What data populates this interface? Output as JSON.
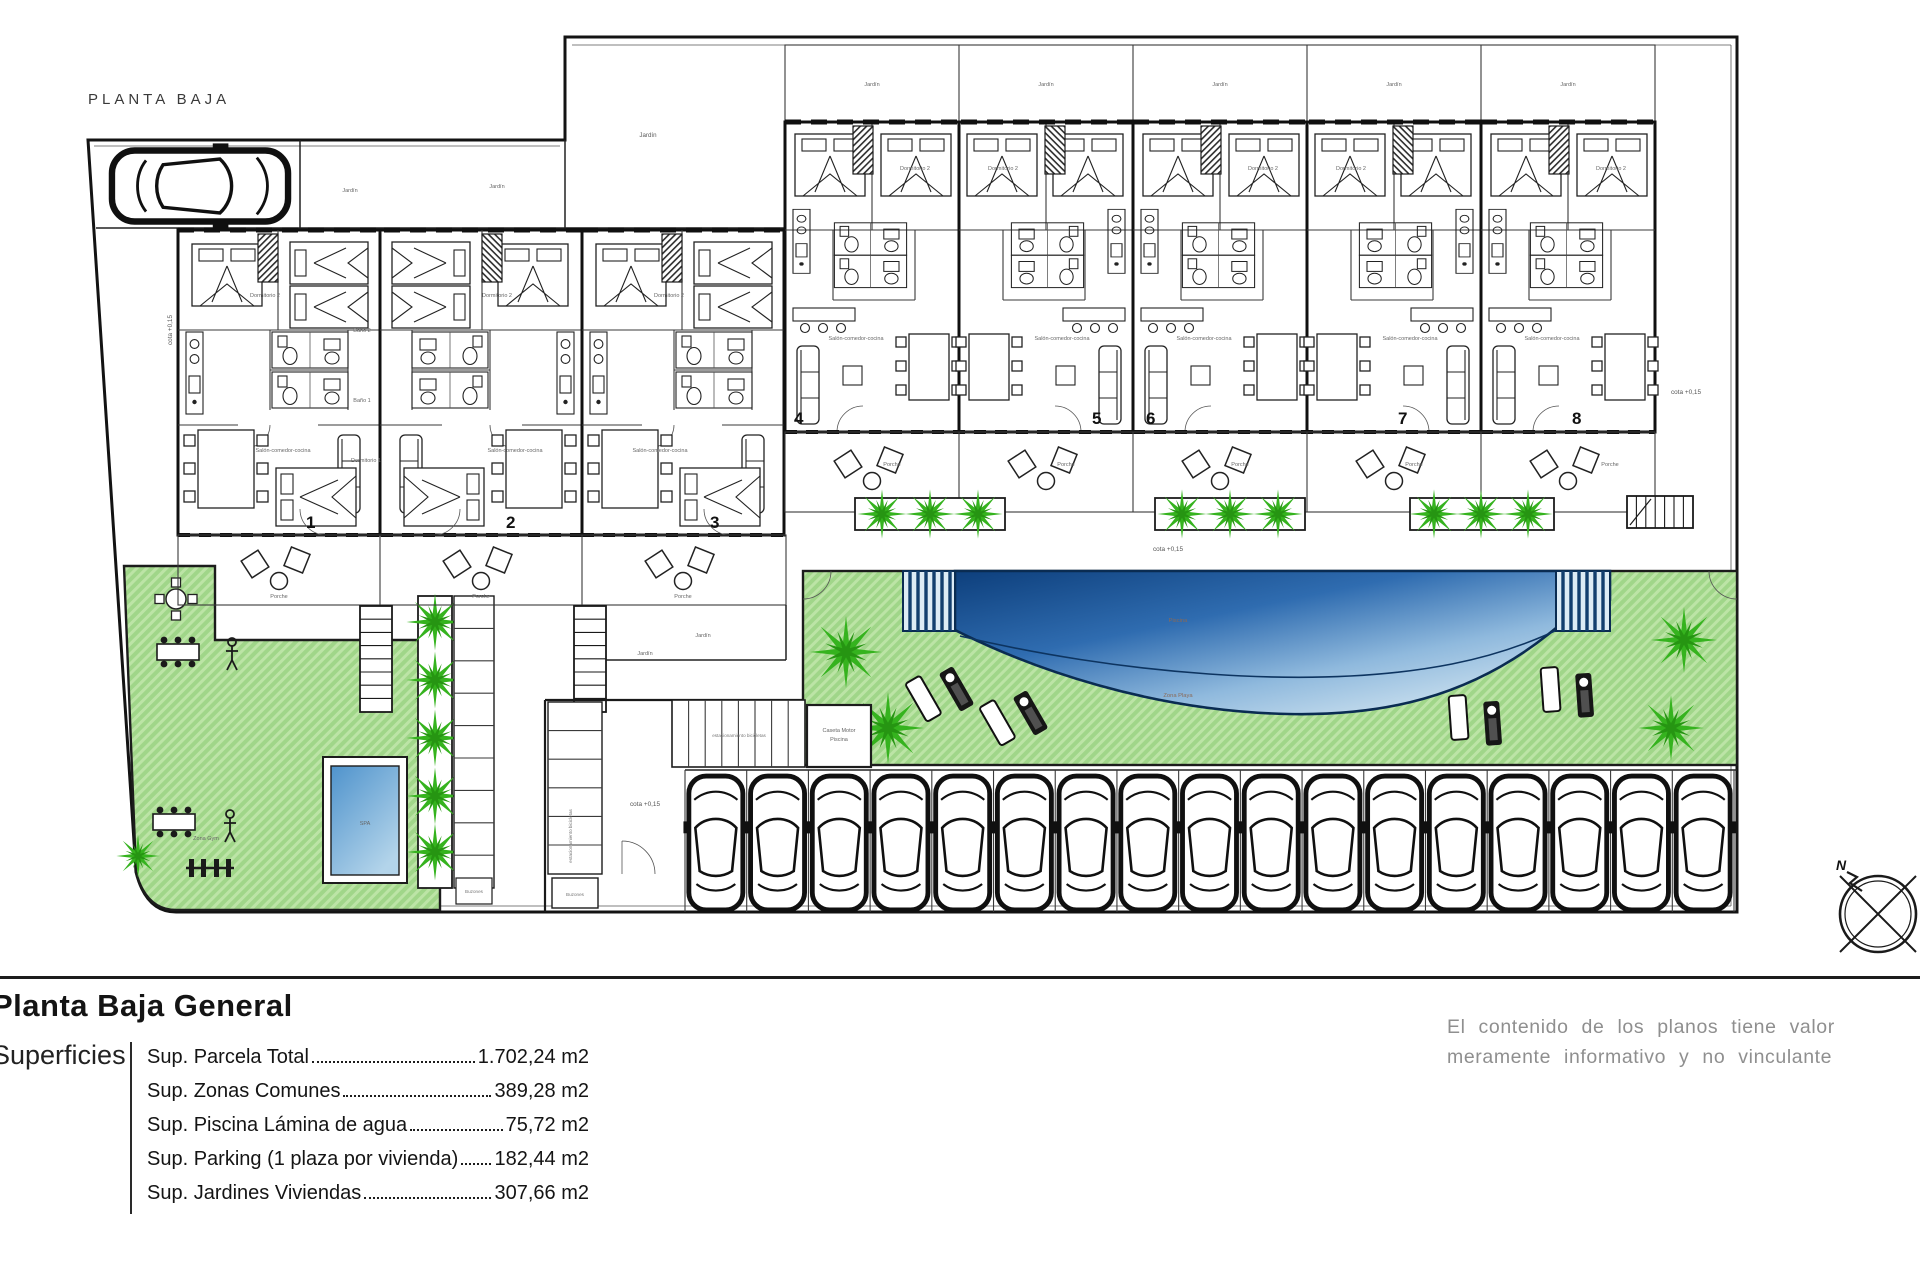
{
  "plan": {
    "title": "PLANTA BAJA",
    "units": [
      "1",
      "2",
      "3",
      "4",
      "5",
      "6",
      "7",
      "8"
    ],
    "labels": {
      "jardin": "Jardín",
      "porche": "Porche",
      "salon": "Salón-comedor-cocina",
      "dormitorio": "Dormitorio 2",
      "dormitorio1": "Dormitorio 1",
      "bano1": "Baño 1",
      "bano2": "Baño 2",
      "cota": "cota +0,15",
      "spa": "SPA",
      "zona_gym": "Zona Gym",
      "piscina": "Piscina",
      "zona_playa": "Zona Playa",
      "caseta1": "Caseta Motor",
      "caseta2": "Piscina",
      "bicis": "estacionamiento bicicletas",
      "buzones": "Buzones",
      "north": "N"
    }
  },
  "title_block": {
    "title": "Planta Baja General",
    "section": "Superficies",
    "rows": [
      {
        "label": "Sup. Parcela Total",
        "value": "1.702,24 m2"
      },
      {
        "label": "Sup. Zonas Comunes",
        "value": "389,28 m2"
      },
      {
        "label": "Sup. Piscina Lámina de agua",
        "value": "75,72 m2"
      },
      {
        "label": "Sup. Parking (1 plaza por vivienda)",
        "value": "182,44 m2"
      },
      {
        "label": "Sup. Jardines Viviendas",
        "value": "307,66 m2"
      }
    ],
    "disclaimer_line1": "El contenido de los planos tiene valor",
    "disclaimer_line2": "meramente informativo y no vinculante"
  },
  "colors": {
    "green": "#a0d689",
    "green_hatch": "#bce4a6",
    "pool_dark": "#0d3f7c",
    "pool_light": "#cfe3f0",
    "line": "#1c1c1c"
  }
}
